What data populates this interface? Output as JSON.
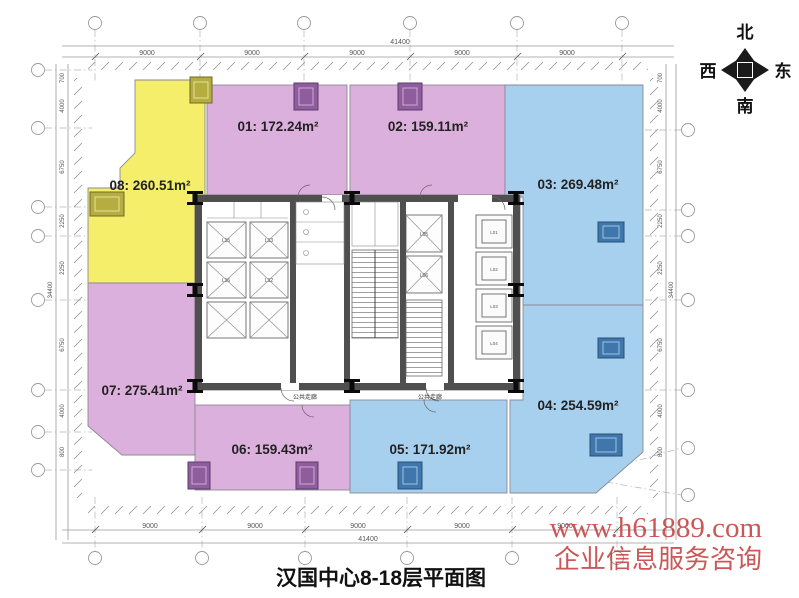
{
  "title": "汉国中心8-18层平面图",
  "watermark": {
    "line1": "www.h61889.com",
    "line2": "企业信息服务咨询",
    "color": "#c23a3a"
  },
  "compass": {
    "north": "北",
    "south": "南",
    "east": "东",
    "west": "西"
  },
  "rooms": [
    {
      "id": "01",
      "area_sqm": 172.24,
      "label": "01: 172.24m²",
      "color": "#dcb0dc"
    },
    {
      "id": "02",
      "area_sqm": 159.11,
      "label": "02: 159.11m²",
      "color": "#dcb0dc"
    },
    {
      "id": "03",
      "area_sqm": 269.48,
      "label": "03: 269.48m²",
      "color": "#a7d0ee"
    },
    {
      "id": "04",
      "area_sqm": 254.59,
      "label": "04: 254.59m²",
      "color": "#a7d0ee"
    },
    {
      "id": "05",
      "area_sqm": 171.92,
      "label": "05: 171.92m²",
      "color": "#a7d0ee"
    },
    {
      "id": "06",
      "area_sqm": 159.43,
      "label": "06: 159.43m²",
      "color": "#dcb0dc"
    },
    {
      "id": "07",
      "area_sqm": 275.41,
      "label": "07: 275.41m²",
      "color": "#dcb0dc"
    },
    {
      "id": "08",
      "area_sqm": 260.51,
      "label": "08: 260.51m²",
      "color": "#f5ee6a"
    }
  ],
  "core": {
    "corridor_label_left": "公共走廊",
    "corridor_label_right": "公共走廊",
    "elevators": [
      "L15",
      "L13",
      "L16",
      "L12",
      "L05",
      "L06",
      "L01",
      "L02",
      "L03",
      "L04"
    ]
  },
  "dimensions": {
    "overall_width": "41400",
    "overall_height": "34400",
    "top": [
      "9000",
      "9000",
      "9000",
      "9000",
      "9000"
    ],
    "bottom": [
      "9000",
      "9000",
      "9000",
      "9000",
      "9000"
    ],
    "left": [
      "700",
      "4000",
      "6750",
      "2250",
      "2250",
      "6750",
      "4000",
      "800"
    ],
    "right": [
      "700",
      "4000",
      "6750",
      "2250",
      "2250",
      "6750",
      "4000",
      "800"
    ]
  }
}
